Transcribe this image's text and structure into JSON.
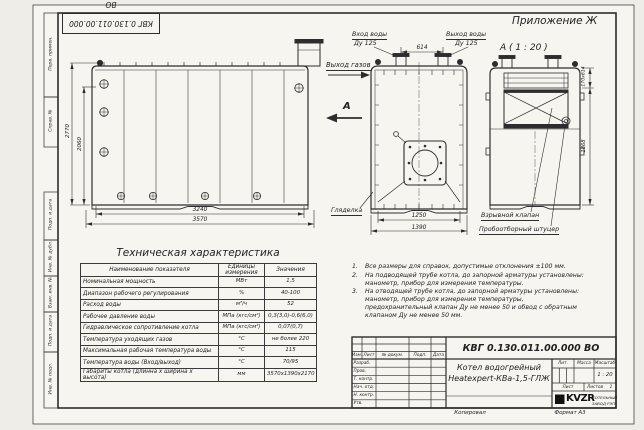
{
  "sheet": {
    "appendix": "Приложение Ж",
    "detail_view": "А ( 1 : 20 )",
    "top_designation": "КВГ 0.130.011.00.000 ВО",
    "copied_label": "Копировал",
    "format_label": "Формат А3"
  },
  "frame": {
    "labels": [
      "Перв. примен.",
      "Справ. №",
      "Подп. и дата",
      "Инв. № дубл.",
      "Взам. инв. №",
      "Подп. и дата",
      "Инв. № подл."
    ]
  },
  "drawing": {
    "labels": {
      "water_inlet": "Вход воды",
      "water_inlet_dn": "Ду 125",
      "water_outlet": "Выход воды",
      "water_outlet_dn": "Ду 125",
      "gas_outlet": "Выход газов",
      "view_arrow": "А",
      "sight_glass": "Гляделка",
      "explosion_valve": "Взрывной клапан",
      "sampling_fitting": "Пробоотборный штуцер"
    },
    "dimensions": {
      "top_span": "614",
      "body_length": "3240",
      "overall_length": "3570",
      "overall_height": "2770",
      "body_height": "2060",
      "body_width": "1250",
      "overall_width": "1390",
      "valve_size": "170х614",
      "rear_height": "1868"
    }
  },
  "spec_table": {
    "title": "Техническая характеристика",
    "headers": [
      "Наименование показателя",
      "Единицы измерения",
      "Значения"
    ],
    "rows": [
      {
        "name": "Номинальная мощность",
        "unit": "МВт",
        "value": "1,5"
      },
      {
        "name": "Диапазон рабочего регулирования",
        "unit": "%",
        "value": "40-100"
      },
      {
        "name": "Расход воды",
        "unit": "м³/ч",
        "value": "52"
      },
      {
        "name": "Рабочее давление воды",
        "unit": "МПа (кгс/см²)",
        "value": "0,3(3,0)-0,6(6,0)"
      },
      {
        "name": "Гидравлическое сопротивление котла",
        "unit": "МПа (кгс/см²)",
        "value": "0,07(0,7)"
      },
      {
        "name": "Температура уходящих газов",
        "unit": "°С",
        "value": "не более 220"
      },
      {
        "name": "Максимальная рабочая температура воды",
        "unit": "°С",
        "value": "115"
      },
      {
        "name": "Температура воды (Вход/выход)",
        "unit": "°С",
        "value": "70/95"
      },
      {
        "name": "Габариты котла (длинна х ширина х высота)",
        "unit": "мм",
        "value": "3570х1390х2170"
      }
    ]
  },
  "notes": {
    "items": [
      {
        "num": "1.",
        "text": "Все размеры для справок, допустимые отклонения ±100 мм."
      },
      {
        "num": "2.",
        "text": "На подводящей трубе котла, до запорной арматуры установлены: манометр, прибор для измерения температуры."
      },
      {
        "num": "3.",
        "text": "На отводящей трубе котла, до запорной арматуры установлены: манометр, прибор для измерения температуры, предохранительный клапан Ду не менее 50 и обвод с обратным клапаном Ду не менее 50 мм."
      }
    ]
  },
  "title_block": {
    "designation": "КВГ 0.130.011.00.000 ВО",
    "product_name_line1": "Котел водогрейный",
    "product_name_line2": "Heatexpert-КВа-1,5-ГЛЖ",
    "header_cols": [
      "Изм.",
      "Лист",
      "№ докум.",
      "Подп.",
      "Дата"
    ],
    "role_rows": [
      "Разраб.",
      "Пров.",
      "Т. контр.",
      "Нач. отд.",
      "Н. контр.",
      "Утв."
    ],
    "lit_label": "Лит.",
    "mass_label": "Масса",
    "scale_label": "Масштаб",
    "scale_value": "1 : 20",
    "sheet_label": "Лист",
    "sheets_label": "Листов",
    "sheets_value": "1",
    "logo_text": "KVZR",
    "company_line1": "КОТЕЛЬНЫЙ",
    "company_line2": "ЗАВОД РЭП"
  }
}
